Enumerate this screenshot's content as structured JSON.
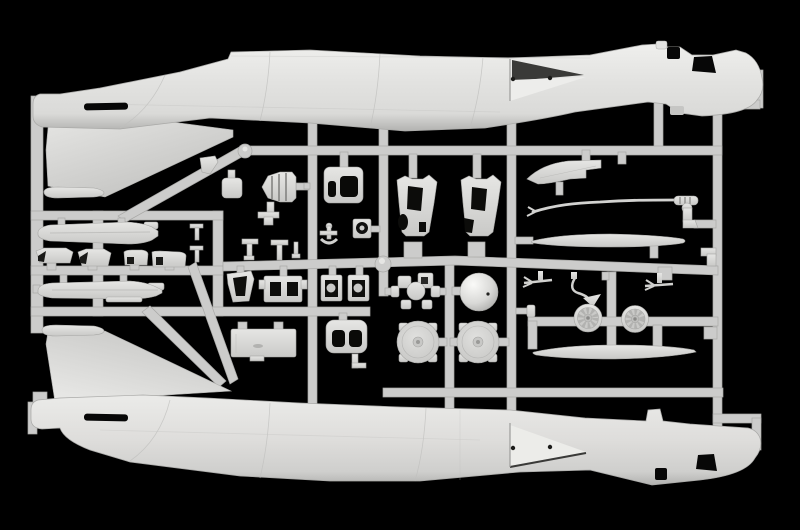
{
  "scene": {
    "type": "photograph",
    "subject": "plastic model aircraft kit sprue on black background",
    "width_px": 800,
    "height_px": 530
  },
  "colors": {
    "background": "#000000",
    "plastic_bright": "#efefed",
    "plastic_base": "#dadad8",
    "plastic_mid": "#cfcfcd",
    "plastic_shadow": "#b2b2b0",
    "runner": "#cccccb",
    "runner_edge": "#a8a8a6",
    "fin_light": "#e9e9e7",
    "fin_dark": "#c3c3c1",
    "dark_opening": "#070707",
    "panel_line": "#b7b7b5"
  },
  "sprue": {
    "material": "light grey polystyrene",
    "fuselage_halves": 2,
    "parts": [
      {
        "id": "upper-fuselage-half",
        "label": "fuselage half, tail left / nose right, fin pointing down"
      },
      {
        "id": "lower-fuselage-half",
        "label": "fuselage half, tail left / nose right, fin pointing up"
      },
      {
        "id": "drop-tank-1",
        "label": "external drop tank half"
      },
      {
        "id": "drop-tank-2",
        "label": "external drop tank half"
      },
      {
        "id": "fairing-row",
        "label": "four small fairing / pylon parts"
      },
      {
        "id": "exhaust-cone",
        "label": "ribbed exhaust cone"
      },
      {
        "id": "intake-box",
        "label": "open intake trunk"
      },
      {
        "id": "intake-duct-a",
        "label": "intake ramp duct"
      },
      {
        "id": "intake-duct-b",
        "label": "intake ramp duct"
      },
      {
        "id": "canopy-rail",
        "label": "canopy rail strip"
      },
      {
        "id": "refueling-probe",
        "label": "long thin probe with ribbed handle"
      },
      {
        "id": "oval-tank-upper",
        "label": "flat lens-shaped tank half"
      },
      {
        "id": "oval-tank-lower",
        "label": "flat lens-shaped tank half"
      },
      {
        "id": "wheel-a",
        "label": "spoked main wheel"
      },
      {
        "id": "wheel-b",
        "label": "spoked main wheel"
      },
      {
        "id": "engine-disc-a",
        "label": "round bulkhead disc with lugs"
      },
      {
        "id": "engine-disc-b",
        "label": "round bulkhead disc with lugs"
      },
      {
        "id": "dome-part",
        "label": "polished hemispherical dome"
      },
      {
        "id": "gearbox-part",
        "label": "cross-shaped gearbox mount"
      },
      {
        "id": "cockpit-tub",
        "label": "tapered tub"
      },
      {
        "id": "window-box",
        "label": "box with two openings"
      },
      {
        "id": "bezel-a",
        "label": "framed square bay part"
      },
      {
        "id": "bezel-b",
        "label": "framed square bay part"
      },
      {
        "id": "equipment-panel",
        "label": "long rectangular panel"
      },
      {
        "id": "duct-end",
        "label": "rounded block with twin openings"
      },
      {
        "id": "antenna-a",
        "label": "small forked antenna"
      },
      {
        "id": "antenna-b",
        "label": "small forked antenna"
      },
      {
        "id": "hook-part",
        "label": "curved hook with arrowhead"
      },
      {
        "id": "elbow-part",
        "label": "boot-shaped elbow"
      },
      {
        "id": "runner-frame",
        "label": "sprue runner grid"
      }
    ]
  }
}
